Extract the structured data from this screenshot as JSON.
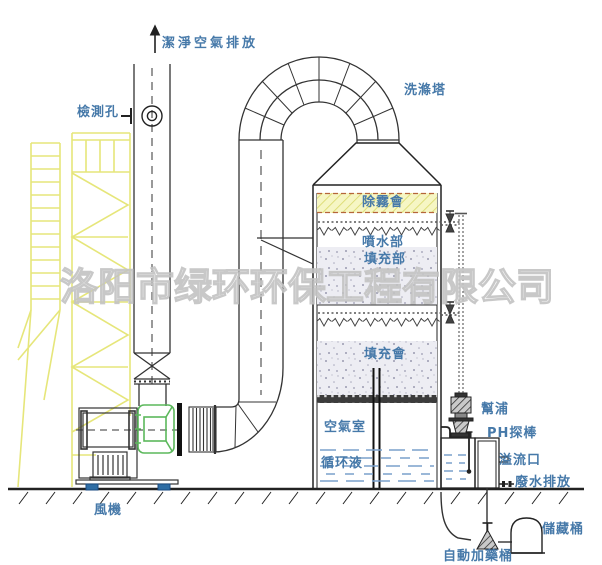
{
  "labels": {
    "clean_air_exhaust": "潔淨空氣排放",
    "inspection_hole": "檢測孔",
    "scrubber_tower": "洗滌塔",
    "demister_layer": "除霧會",
    "spray_section": "噴水部",
    "packing_section": "填充部",
    "packing_layer": "填充會",
    "air_chamber": "空氣室",
    "circulating_liquid": "循环液",
    "pump": "幫浦",
    "ph_probe": "PH探棒",
    "overflow_port": "溢流口",
    "wastewater_discharge": "廢水排放",
    "storage_tank": "儲藏桶",
    "auto_dosing_tank": "自動加藥桶",
    "fan": "風機"
  },
  "watermark": {
    "text": "洛阳市绿环环保工程有限公司"
  },
  "colors": {
    "label_blue": "#4679a9",
    "watermark_gray": "#c3c3c3",
    "scaffold_yellow": "#e6e67a",
    "demister_band_yellow": "#f6f6c4",
    "demister_dash_brown": "#b5653a",
    "packing_stipple": "#ededf3",
    "liquid_blue": "#7aa0cc",
    "fan_green": "#5cb85c",
    "mount_blue": "#2e6da4",
    "line_dark": "#333333"
  }
}
